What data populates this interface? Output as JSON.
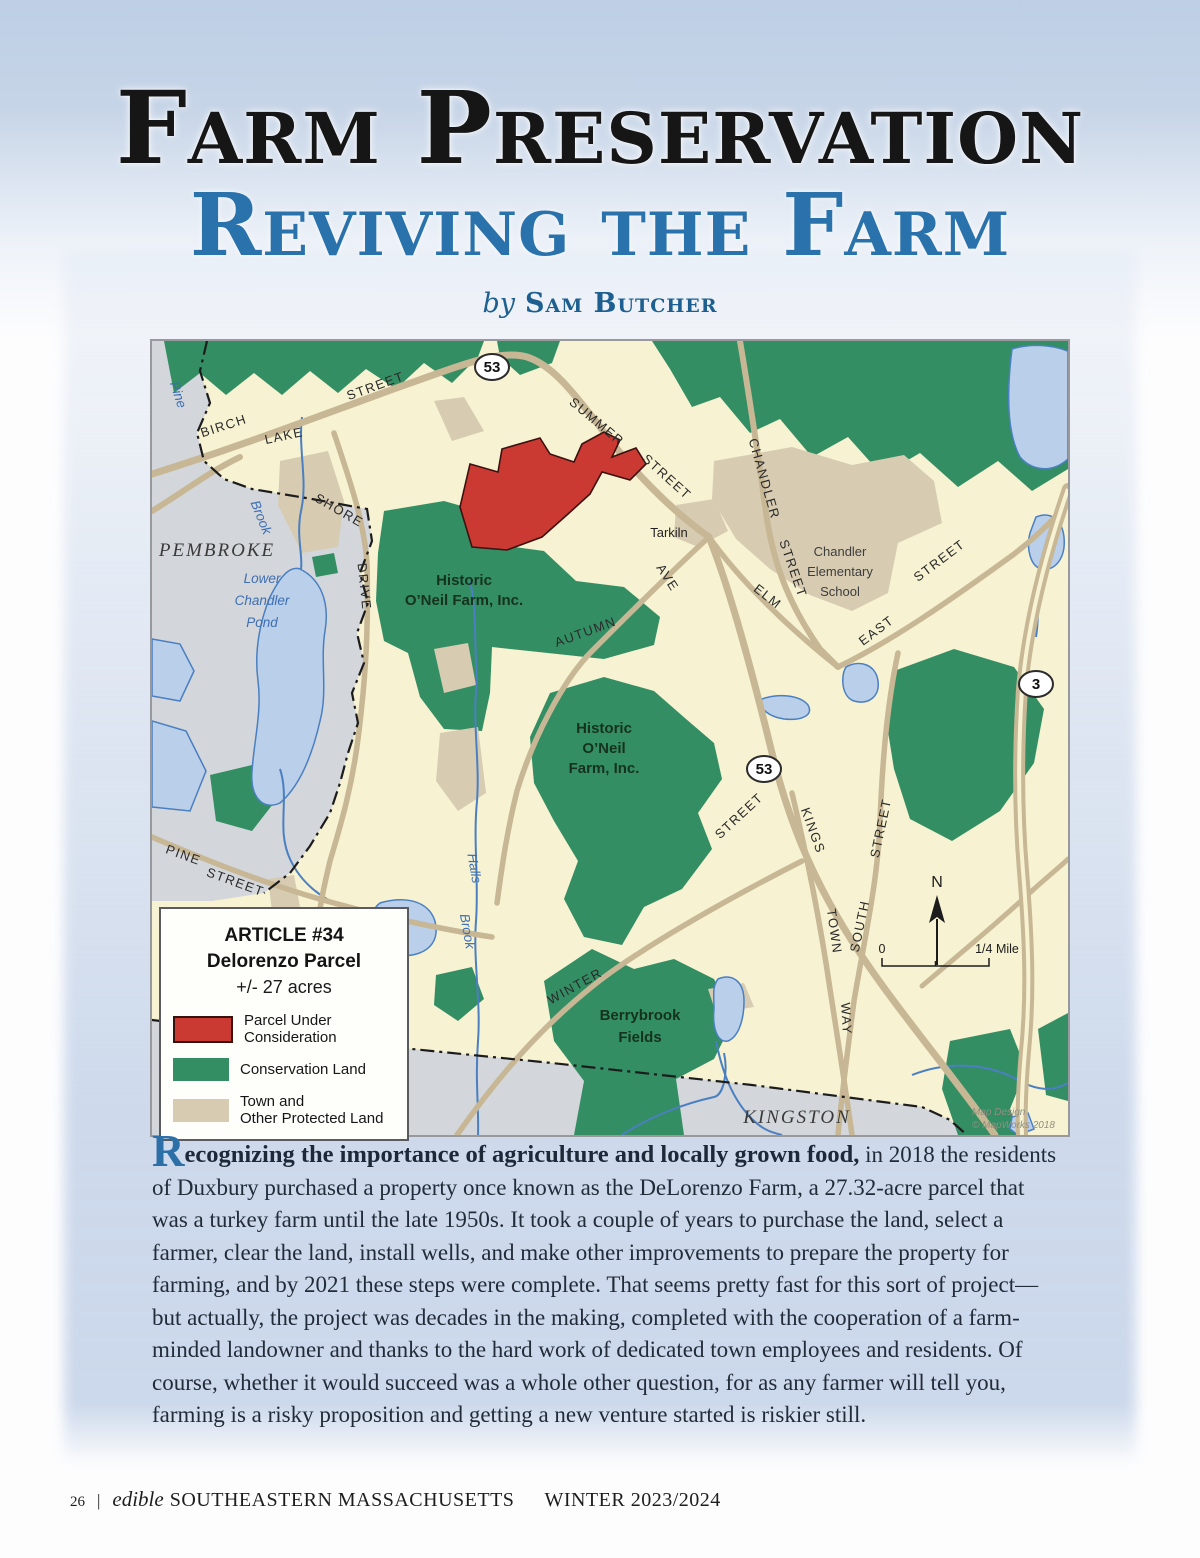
{
  "page": {
    "title_line1": "Farm Preservation",
    "title_line2": "Reviving the Farm",
    "byline_prefix": "by",
    "byline_author": "Sam Butcher"
  },
  "map": {
    "towns": [
      "PEMBROKE",
      "KINGSTON"
    ],
    "street_labels": [
      "BIRCH",
      "LAKE",
      "STREET",
      "SHORE",
      "DRIVE",
      "SUMMER",
      "STREET",
      "CHANDLER",
      "STREET",
      "Tarkiln",
      "AVE",
      "ELM",
      "EAST",
      "STREET",
      "AUTUMN",
      "STREET",
      "KINGS",
      "TOWN",
      "WAY",
      "SOUTH",
      "STREET",
      "WINTER",
      "PINE",
      "STREET"
    ],
    "water_labels": [
      "Pine",
      "Brook",
      "Lower",
      "Chandler",
      "Pond",
      "Halls",
      "Brook"
    ],
    "area_labels": [
      "Historic",
      "O’Neil Farm, Inc.",
      "Historic",
      "O’Neil",
      "Farm, Inc.",
      "Berrybrook",
      "Fields"
    ],
    "poi_labels": [
      "Chandler",
      "Elementary",
      "School"
    ],
    "shields": [
      "53",
      "53",
      "3"
    ],
    "compass_n": "N",
    "scale_zero": "0",
    "scale_label": "1/4 Mile",
    "credit_line1": "Map Design",
    "credit_line2": "© MapWorks 2018",
    "legend": {
      "title": "ARTICLE #34",
      "subtitle": "Delorenzo Parcel",
      "acreage": "+/- 27 acres",
      "items": [
        {
          "line1": "Parcel Under",
          "line2": "Consideration"
        },
        {
          "line1": "Conservation Land",
          "line2": ""
        },
        {
          "line1": "Town and",
          "line2": "Other Protected Land"
        }
      ]
    },
    "colors": {
      "parcel_red": "#cb3a32",
      "conservation_green": "#348e63",
      "protected_tan": "#d7ccb2",
      "water_blue": "#b9cfea",
      "road_tan": "#c7b795",
      "town_gray": "#d3d6da",
      "map_cream": "#f6f2d2"
    }
  },
  "article": {
    "initial": "R",
    "lead_rest": "ecognizing the importance of agriculture and locally grown food,",
    "body": "in 2018 the residents of Duxbury purchased a property once known as the DeLorenzo Farm, a 27.32-acre parcel that was a turkey farm until the late 1950s. It took a couple of years to purchase the land, select a farmer, clear the land, install wells, and make other improvements to prepare the property for farming, and by 2021 these steps were complete. That seems pretty fast for this sort of project—but actually, the project was decades in the making, completed with the cooperation of a farm-minded landowner and thanks to the hard work of dedicated town employees and residents. Of course, whether it would succeed was a whole other question, for as any farmer will tell you, farming is a risky proposition and getting a new venture started is riskier still."
  },
  "footer": {
    "page_number": "26",
    "separator": "|",
    "brand_italic": "edible",
    "brand_caps": "SOUTHEASTERN MASSACHUSETTS",
    "issue": "WINTER 2023/2024"
  }
}
